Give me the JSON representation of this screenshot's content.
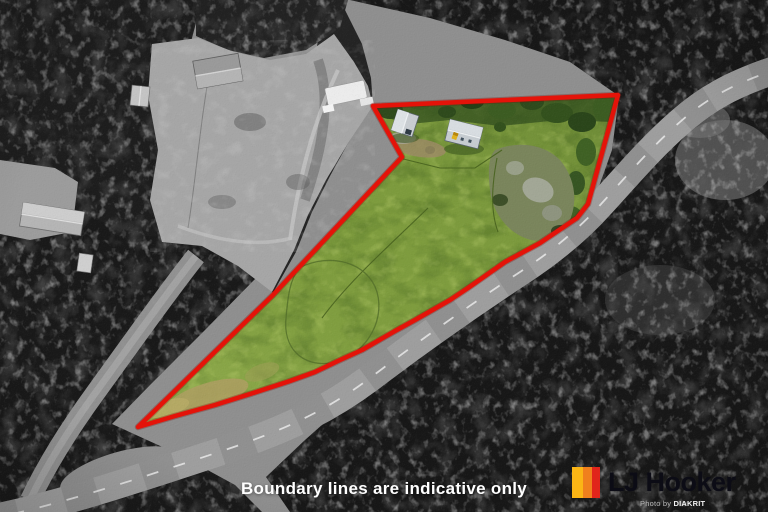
{
  "caption": "Boundary lines are indicative only",
  "logo": {
    "brand": "LJ Hooker",
    "mark": "three-vertical-stripes",
    "stripes": {
      "yellow": "#fbb515",
      "orange": "#f0801d",
      "red": "#e1251b"
    },
    "credit_prefix": "Photo by ",
    "credit_brand": "DIAKRIT"
  },
  "colors": {
    "boundary": "#e41309",
    "grass": "#7e9c3e"
  }
}
